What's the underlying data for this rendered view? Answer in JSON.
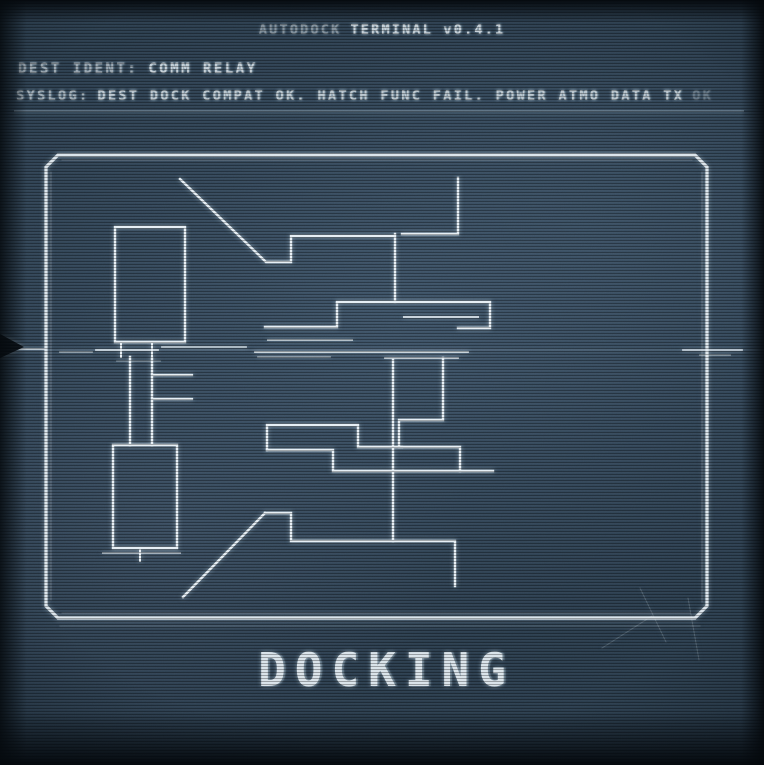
{
  "header": {
    "title_dim": "AUTODOCK",
    "title_bright": "TERMINAL v0.4.1"
  },
  "status": {
    "dest_label": "DEST IDENT:",
    "dest_value": "COMM RELAY",
    "syslog_label": "SYSLOG:",
    "syslog_main": "DEST DOCK COMPAT OK. HATCH FUNC FAIL. POWER ATMO DATA TX",
    "syslog_faded": "OK"
  },
  "schematic": {
    "caption": "DOCKING"
  },
  "colors": {
    "background": "#2a3c4c",
    "blueprint_line": "#e8f1f6",
    "text": "#c3ced6",
    "caption_text": "#d8e2e9"
  }
}
